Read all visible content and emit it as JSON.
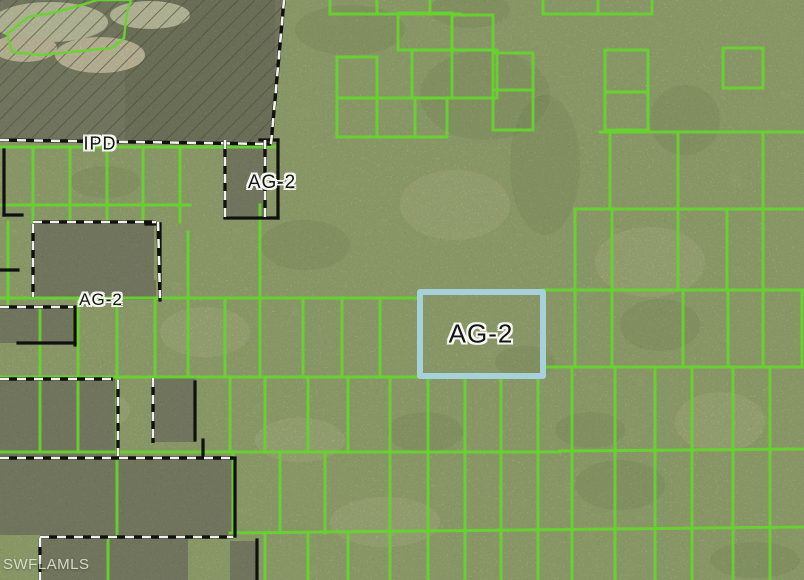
{
  "map": {
    "width": 804,
    "height": 580,
    "colors": {
      "base": "#a9bc79",
      "parcel_line": "#67d42e",
      "woods": "#6e7259",
      "woods_dark": "#63684e",
      "hatch_line": "#32322a",
      "cleared_light": "#d2d4b0",
      "cleared_tan": "#d9cfae",
      "boundary_black": "#101010",
      "boundary_dash_white": "#f2f2ea",
      "highlight": "#a7d1da",
      "mottle_dark": "#55713a",
      "mottle_light": "#c6cf92"
    },
    "labels": [
      {
        "id": "ipd",
        "text": "IPD",
        "x": 100,
        "y": 144,
        "size": 18
      },
      {
        "id": "ag2-north",
        "text": "AG-2",
        "x": 272,
        "y": 183,
        "size": 19
      },
      {
        "id": "ag2-west",
        "text": "AG-2",
        "x": 101,
        "y": 300,
        "size": 17
      },
      {
        "id": "ag2-selected",
        "text": "AG-2",
        "x": 481,
        "y": 334,
        "size": 26
      }
    ],
    "watermark": {
      "text": "SWFLAMLS"
    },
    "highlight_parcel": {
      "x": 420,
      "y": 292,
      "w": 123,
      "h": 84,
      "stroke_width": 6
    },
    "hatch_region": {
      "polygon": [
        [
          0,
          0
        ],
        [
          285,
          0
        ],
        [
          272,
          144
        ],
        [
          0,
          139
        ]
      ],
      "woods_rect": [
        125,
        0,
        150,
        142
      ],
      "cleared_ellipses": [
        [
          50,
          22,
          58,
          20,
          "cleared_light"
        ],
        [
          100,
          55,
          45,
          18,
          "cleared_tan"
        ],
        [
          25,
          48,
          32,
          14,
          "cleared_tan"
        ],
        [
          150,
          15,
          40,
          14,
          "cleared_light"
        ]
      ]
    },
    "green_polygon": [
      [
        7,
        34
      ],
      [
        28,
        17
      ],
      [
        57,
        12
      ],
      [
        88,
        3
      ],
      [
        97,
        0
      ],
      [
        131,
        0
      ],
      [
        127,
        12
      ],
      [
        124,
        38
      ],
      [
        112,
        48
      ],
      [
        40,
        55
      ],
      [
        12,
        52
      ]
    ],
    "green_rects": [
      [
        398,
        13,
        54,
        37
      ],
      [
        452,
        15,
        41,
        35
      ],
      [
        412,
        50,
        85,
        48
      ],
      [
        337,
        57,
        40,
        41
      ],
      [
        337,
        98,
        110,
        39
      ],
      [
        493,
        53,
        40,
        77
      ],
      [
        605,
        50,
        43,
        42
      ],
      [
        605,
        92,
        43,
        38
      ],
      [
        723,
        48,
        40,
        40
      ]
    ],
    "green_segments": [
      [
        330,
        0,
        330,
        14
      ],
      [
        377,
        0,
        377,
        14
      ],
      [
        430,
        0,
        430,
        14
      ],
      [
        330,
        14,
        460,
        14
      ],
      [
        543,
        0,
        543,
        14
      ],
      [
        598,
        0,
        598,
        14
      ],
      [
        652,
        0,
        652,
        14
      ],
      [
        543,
        14,
        652,
        14
      ],
      [
        452,
        50,
        452,
        98
      ],
      [
        377,
        98,
        377,
        137
      ],
      [
        415,
        98,
        415,
        137
      ],
      [
        493,
        90,
        533,
        90
      ],
      [
        600,
        132,
        804,
        132
      ],
      [
        575,
        209,
        804,
        209
      ],
      [
        610,
        132,
        610,
        209
      ],
      [
        678,
        132,
        678,
        290
      ],
      [
        763,
        132,
        763,
        290
      ],
      [
        575,
        209,
        575,
        290
      ],
      [
        612,
        209,
        612,
        290
      ],
      [
        727,
        209,
        727,
        290
      ],
      [
        0,
        298,
        420,
        298
      ],
      [
        543,
        290,
        804,
        290
      ],
      [
        0,
        377,
        420,
        377
      ],
      [
        543,
        367,
        804,
        367
      ],
      [
        0,
        147,
        278,
        147
      ],
      [
        33,
        147,
        33,
        222
      ],
      [
        70,
        147,
        70,
        222
      ],
      [
        107,
        147,
        107,
        222
      ],
      [
        143,
        147,
        143,
        222
      ],
      [
        180,
        147,
        180,
        222
      ],
      [
        0,
        205,
        190,
        205
      ],
      [
        8,
        222,
        8,
        307
      ],
      [
        188,
        232,
        188,
        377
      ],
      [
        260,
        205,
        260,
        377
      ],
      [
        225,
        298,
        225,
        377
      ],
      [
        303,
        298,
        303,
        377
      ],
      [
        342,
        298,
        342,
        377
      ],
      [
        380,
        298,
        380,
        377
      ],
      [
        78,
        298,
        78,
        452
      ],
      [
        117,
        298,
        117,
        458
      ],
      [
        40,
        307,
        40,
        452
      ],
      [
        155,
        298,
        155,
        377
      ],
      [
        575,
        290,
        575,
        367
      ],
      [
        612,
        290,
        612,
        367
      ],
      [
        683,
        290,
        683,
        367
      ],
      [
        728,
        290,
        728,
        367
      ],
      [
        763,
        290,
        763,
        367
      ],
      [
        802,
        290,
        802,
        367
      ],
      [
        230,
        377,
        230,
        452
      ],
      [
        265,
        377,
        265,
        452
      ],
      [
        308,
        377,
        308,
        452
      ],
      [
        348,
        377,
        348,
        452
      ],
      [
        390,
        377,
        390,
        452
      ],
      [
        428,
        377,
        428,
        452
      ],
      [
        465,
        377,
        465,
        452
      ],
      [
        501,
        377,
        501,
        452
      ],
      [
        538,
        377,
        538,
        452
      ],
      [
        572,
        367,
        572,
        450
      ],
      [
        615,
        367,
        615,
        450
      ],
      [
        655,
        367,
        655,
        450
      ],
      [
        692,
        367,
        692,
        450
      ],
      [
        733,
        367,
        733,
        450
      ],
      [
        770,
        367,
        770,
        450
      ],
      [
        0,
        452,
        560,
        452
      ],
      [
        560,
        451,
        804,
        449
      ],
      [
        233,
        452,
        233,
        533
      ],
      [
        280,
        452,
        280,
        533
      ],
      [
        325,
        452,
        325,
        533
      ],
      [
        390,
        452,
        390,
        533
      ],
      [
        428,
        452,
        428,
        533
      ],
      [
        465,
        452,
        465,
        533
      ],
      [
        501,
        452,
        501,
        533
      ],
      [
        538,
        452,
        538,
        533
      ],
      [
        572,
        450,
        572,
        528
      ],
      [
        615,
        450,
        615,
        528
      ],
      [
        655,
        450,
        655,
        528
      ],
      [
        692,
        450,
        692,
        528
      ],
      [
        733,
        450,
        733,
        528
      ],
      [
        770,
        450,
        770,
        528
      ],
      [
        230,
        533,
        804,
        527
      ],
      [
        265,
        533,
        265,
        580
      ],
      [
        308,
        533,
        308,
        580
      ],
      [
        348,
        533,
        348,
        580
      ],
      [
        390,
        533,
        390,
        580
      ],
      [
        428,
        533,
        428,
        580
      ],
      [
        465,
        533,
        465,
        580
      ],
      [
        501,
        533,
        501,
        580
      ],
      [
        538,
        533,
        538,
        580
      ],
      [
        572,
        528,
        572,
        580
      ],
      [
        615,
        528,
        615,
        580
      ],
      [
        655,
        528,
        655,
        580
      ],
      [
        692,
        528,
        692,
        580
      ],
      [
        733,
        528,
        733,
        580
      ],
      [
        770,
        528,
        770,
        580
      ],
      [
        108,
        540,
        108,
        580
      ],
      [
        117,
        458,
        117,
        535
      ]
    ],
    "dark_parcels": [
      [
        227,
        141,
        38,
        75
      ],
      [
        33,
        224,
        121,
        74
      ],
      [
        77,
        280,
        79,
        20
      ],
      [
        0,
        307,
        73,
        36
      ],
      [
        0,
        378,
        116,
        78
      ],
      [
        154,
        378,
        42,
        64
      ],
      [
        0,
        459,
        234,
        76
      ],
      [
        42,
        538,
        146,
        42
      ],
      [
        230,
        541,
        28,
        39
      ]
    ],
    "black_segments": [
      [
        278,
        140,
        278,
        218
      ],
      [
        260,
        140,
        278,
        140
      ],
      [
        225,
        218,
        278,
        218
      ],
      [
        4,
        150,
        4,
        215
      ],
      [
        4,
        215,
        22,
        215
      ],
      [
        160,
        224,
        160,
        300
      ],
      [
        146,
        224,
        160,
        224
      ],
      [
        0,
        270,
        18,
        270
      ],
      [
        75,
        307,
        75,
        345
      ],
      [
        18,
        343,
        75,
        343
      ],
      [
        195,
        382,
        195,
        440
      ],
      [
        203,
        440,
        203,
        458
      ],
      [
        235,
        459,
        235,
        536
      ],
      [
        222,
        458,
        235,
        458
      ],
      [
        257,
        540,
        257,
        580
      ]
    ],
    "dashed_polylines": [
      [
        [
          0,
          140
        ],
        [
          271,
          144
        ]
      ],
      [
        [
          271,
          144
        ],
        [
          284,
          0
        ]
      ],
      [
        [
          225,
          140
        ],
        [
          225,
          218
        ]
      ],
      [
        [
          265,
          140
        ],
        [
          265,
          218
        ]
      ],
      [
        [
          33,
          222
        ],
        [
          156,
          222
        ]
      ],
      [
        [
          158,
          222
        ],
        [
          160,
          298
        ]
      ],
      [
        [
          33,
          224
        ],
        [
          33,
          297
        ]
      ],
      [
        [
          0,
          307
        ],
        [
          73,
          307
        ]
      ],
      [
        [
          118,
          380
        ],
        [
          118,
          456
        ]
      ],
      [
        [
          0,
          379
        ],
        [
          113,
          379
        ]
      ],
      [
        [
          153,
          378
        ],
        [
          153,
          443
        ]
      ],
      [
        [
          0,
          458
        ],
        [
          233,
          458
        ]
      ],
      [
        [
          40,
          537
        ],
        [
          233,
          537
        ]
      ],
      [
        [
          40,
          538
        ],
        [
          40,
          580
        ]
      ]
    ],
    "blotches_dark": [
      [
        485,
        95,
        65,
        45
      ],
      [
        545,
        165,
        35,
        70
      ],
      [
        350,
        30,
        55,
        25
      ],
      [
        660,
        325,
        40,
        26
      ],
      [
        235,
        82,
        35,
        22
      ],
      [
        620,
        485,
        45,
        25
      ],
      [
        755,
        560,
        45,
        18
      ],
      [
        305,
        245,
        45,
        25
      ],
      [
        685,
        120,
        35,
        35
      ],
      [
        425,
        432,
        38,
        20
      ],
      [
        105,
        182,
        35,
        16
      ],
      [
        525,
        362,
        30,
        16
      ],
      [
        470,
        10,
        40,
        18
      ],
      [
        590,
        430,
        35,
        18
      ]
    ],
    "blotches_light": [
      [
        650,
        262,
        55,
        35
      ],
      [
        205,
        332,
        45,
        25
      ],
      [
        455,
        205,
        55,
        35
      ],
      [
        720,
        422,
        45,
        30
      ],
      [
        385,
        522,
        55,
        25
      ],
      [
        90,
        410,
        40,
        22
      ],
      [
        300,
        440,
        45,
        22
      ]
    ]
  }
}
